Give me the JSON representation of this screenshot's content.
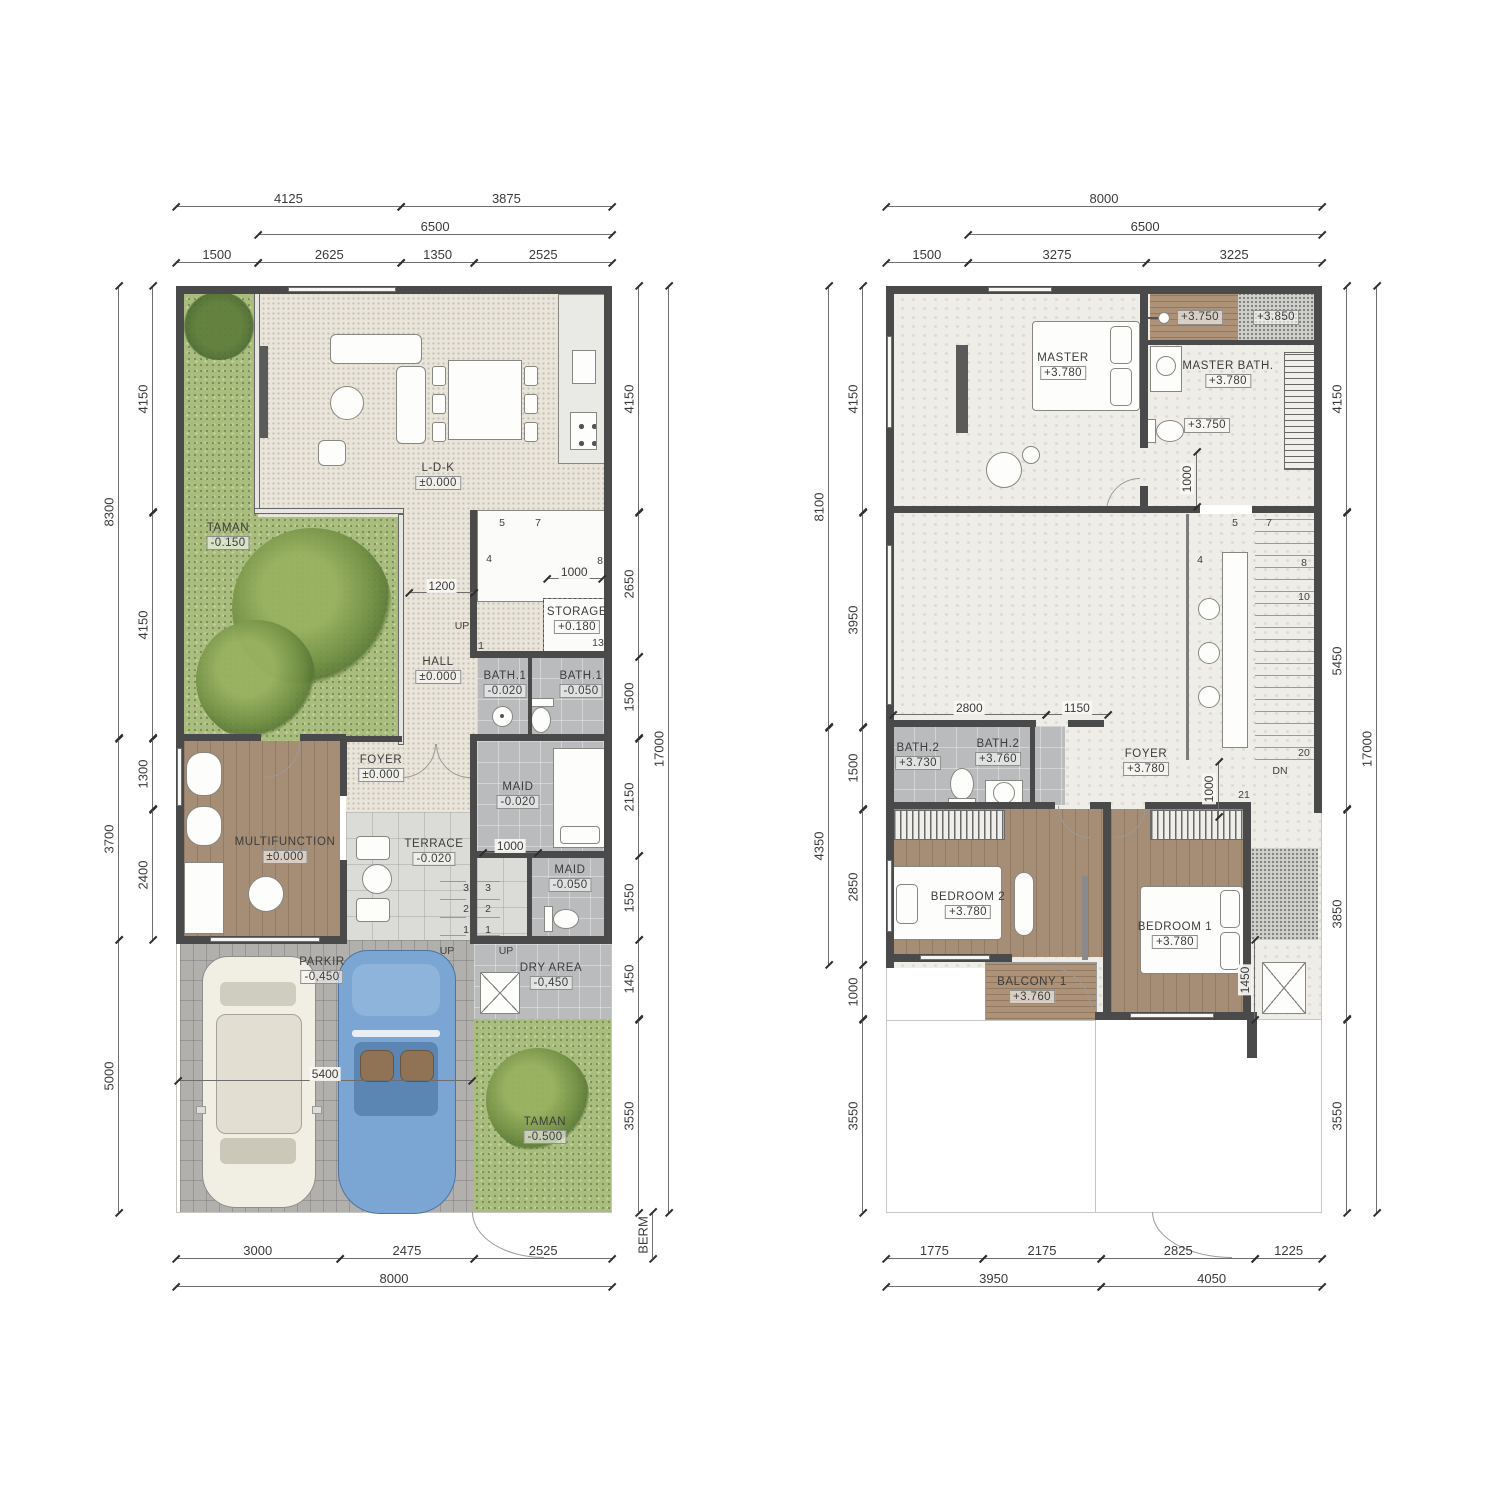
{
  "colors": {
    "wall": "#4a4a4a",
    "grass": "#a9bd7e",
    "wood_floor": "#a68d76",
    "tile_gray": "#babbbd",
    "stone": "#dbdbd7",
    "pavers": "#b2b0ad",
    "cream_floor": "#e9e5db",
    "marble": "#efede7",
    "car_blue": "#7ba6d3",
    "car_cream": "#f1eee4"
  },
  "ground": {
    "dims": {
      "top1": [
        "4125",
        "3875"
      ],
      "top2": [
        "6500"
      ],
      "top3": [
        "1500",
        "2625",
        "1350",
        "2525"
      ],
      "left_outer": [
        "8300",
        "3700",
        "5000"
      ],
      "left_inner": [
        "4150",
        "4150",
        "1300",
        "2400"
      ],
      "right_inner": [
        "4150",
        "2650",
        "1500",
        "2150",
        "1550",
        "1450",
        "3550"
      ],
      "right_outer": [
        "17000"
      ],
      "bottom1": [
        "3000",
        "2475",
        "2525"
      ],
      "bottom2": [
        "8000"
      ],
      "inline_1200": [
        "1200"
      ],
      "inline_1000_storage": [
        "1000"
      ],
      "inline_1000_maid": [
        "1000"
      ],
      "inline_5400": [
        "5400"
      ],
      "berm": [
        "BERM"
      ]
    },
    "rooms": {
      "taman": {
        "name": "TAMAN",
        "level": "-0.150"
      },
      "ldk": {
        "name": "L-D-K",
        "level": "±0.000"
      },
      "hall": {
        "name": "HALL",
        "level": "±0.000"
      },
      "storage": {
        "name": "STORAGE",
        "level": "+0.180"
      },
      "bath1a": {
        "name": "BATH.1",
        "level": "-0.020"
      },
      "bath1b": {
        "name": "BATH.1",
        "level": "-0.050"
      },
      "foyer": {
        "name": "FOYER",
        "level": "±0.000"
      },
      "multifunction": {
        "name": "MULTIFUNCTION",
        "level": "±0.000"
      },
      "terrace": {
        "name": "TERRACE",
        "level": "-0.020"
      },
      "maid1": {
        "name": "MAID",
        "level": "-0.020"
      },
      "maid2": {
        "name": "MAID",
        "level": "-0.050"
      },
      "dry": {
        "name": "DRY AREA",
        "level": "-0,450"
      },
      "parkir": {
        "name": "PARKIR",
        "level": "-0,450"
      },
      "taman2": {
        "name": "TAMAN",
        "level": "-0.500"
      }
    },
    "stairs": {
      "n5": "5",
      "n7": "7",
      "n4": "4",
      "n8": "8",
      "n13": "13",
      "n1": "1",
      "up": "UP",
      "t1": "1",
      "t2": "2",
      "t3": "3"
    }
  },
  "upper": {
    "dims": {
      "top1": [
        "8000"
      ],
      "top2": [
        "6500"
      ],
      "top3": [
        "1500",
        "3275",
        "3225"
      ],
      "left_outer": [
        "8100",
        "4350"
      ],
      "left_inner": [
        "4150",
        "3950",
        "1500",
        "2850",
        "1000",
        "3550"
      ],
      "right_inner": [
        "4150",
        "5450",
        "3850",
        "3550"
      ],
      "right_outer": [
        "17000"
      ],
      "bottom1": [
        "1775",
        "2175",
        "2825",
        "1225"
      ],
      "bottom2": [
        "3950",
        "4050"
      ],
      "inline_2800_1150": [
        "2800",
        "1150"
      ],
      "inline_1000_dn": [
        "1000"
      ],
      "inline_1000_mb": [
        "1000"
      ],
      "inline_1450": [
        "1450"
      ]
    },
    "rooms": {
      "master": {
        "name": "MASTER",
        "level": "+3.780"
      },
      "shower": {
        "level": "+3.750"
      },
      "gravel": {
        "level": "+3.850"
      },
      "masterbath": {
        "name": "MASTER BATH.",
        "level": "+3.780"
      },
      "wc": {
        "level": "+3.750"
      },
      "bath2a": {
        "name": "BATH.2",
        "level": "+3.730"
      },
      "bath2b": {
        "name": "BATH.2",
        "level": "+3.760"
      },
      "foyer": {
        "name": "FOYER",
        "level": "+3.780"
      },
      "bedroom2": {
        "name": "BEDROOM 2",
        "level": "+3.780"
      },
      "bedroom1": {
        "name": "BEDROOM 1",
        "level": "+3.780"
      },
      "balcony": {
        "name": "BALCONY 1",
        "level": "+3.760"
      }
    },
    "stairs": {
      "n5": "5",
      "n7": "7",
      "n4": "4",
      "n8": "8",
      "n10": "10",
      "n20": "20",
      "n21": "21",
      "dn": "DN"
    }
  }
}
